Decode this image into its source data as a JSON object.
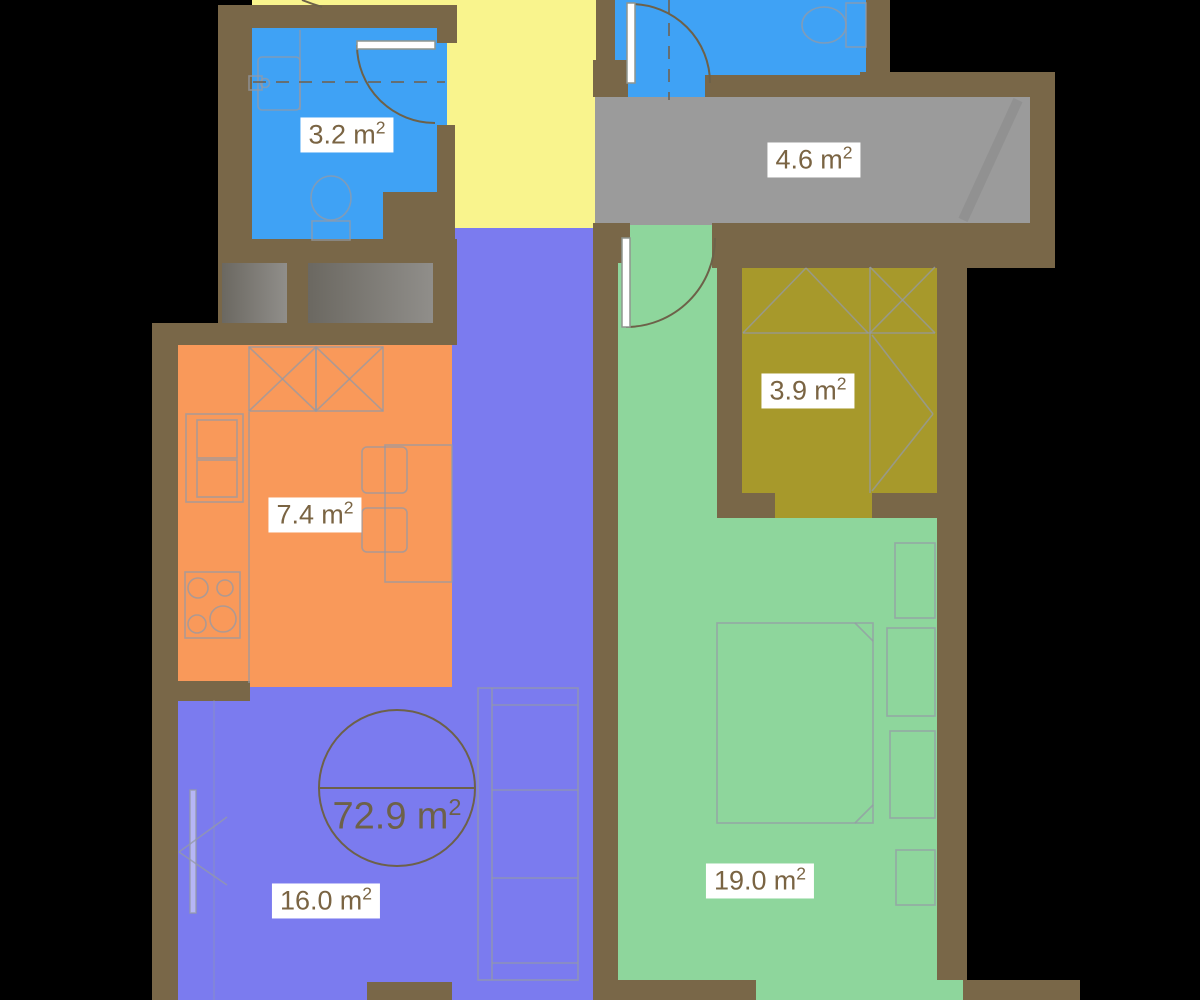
{
  "plan": {
    "background_color": "#000000",
    "wall_color": "#796748",
    "label_text_color": "#7a6443",
    "furniture_line_color": "#949aa6",
    "total_area": {
      "value": "72.9",
      "unit": "m",
      "exponent": "2"
    },
    "rooms": [
      {
        "id": "bathroom-top-left",
        "type": "bathroom",
        "color": "#3fa2f5",
        "area": {
          "value": "3.2",
          "unit": "m",
          "exponent": "2"
        }
      },
      {
        "id": "hallway",
        "type": "hallway",
        "color": "#f9f48d",
        "area": null
      },
      {
        "id": "bathroom-top-right",
        "type": "bathroom",
        "color": "#3fa2f5",
        "area": null
      },
      {
        "id": "corridor",
        "type": "corridor",
        "color": "#9b9b9b",
        "area": {
          "value": "4.6",
          "unit": "m",
          "exponent": "2"
        }
      },
      {
        "id": "wardrobe",
        "type": "wardrobe",
        "color": "#a7992b",
        "area": {
          "value": "3.9",
          "unit": "m",
          "exponent": "2"
        }
      },
      {
        "id": "kitchen",
        "type": "kitchen",
        "color": "#f9995a",
        "area": {
          "value": "7.4",
          "unit": "m",
          "exponent": "2"
        }
      },
      {
        "id": "living-room",
        "type": "living room",
        "color": "#7b7bef",
        "area": {
          "value": "16.0",
          "unit": "m",
          "exponent": "2"
        }
      },
      {
        "id": "bedroom",
        "type": "bedroom",
        "color": "#8ed69c",
        "area": {
          "value": "19.0",
          "unit": "m",
          "exponent": "2"
        }
      }
    ]
  }
}
